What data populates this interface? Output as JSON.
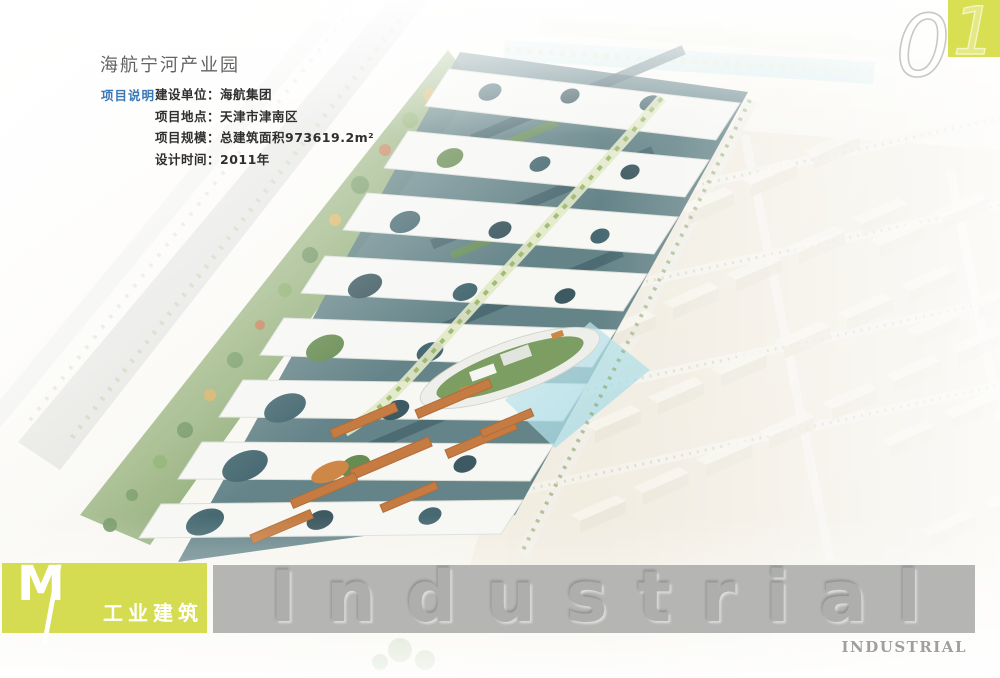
{
  "header": {
    "title": "海航宁河产业园",
    "section_label": "项目说明",
    "details": [
      {
        "label": "建设单位：",
        "value": "海航集团"
      },
      {
        "label": "项目地点：",
        "value": "天津市津南区"
      },
      {
        "label": "项目规模：",
        "value": "总建筑面积973619.2m²"
      },
      {
        "label": "设计时间：",
        "value": "2011年"
      }
    ]
  },
  "page_number": {
    "value": "01",
    "first_digit": "0",
    "second_digit": "1"
  },
  "footer": {
    "category_letter": "M",
    "category_divider": "/",
    "category_label": "工业建筑",
    "watermark": "Industrial",
    "corner_label": "INDUSTRIAL"
  },
  "image": {
    "alt": "海航宁河产业园鸟瞰效果图：白色开孔屋面带覆盖的玻璃厂房群、中央绿化景观轴、椭圆形绿顶办公楼与水景、橙色屋顶宿舍楼，左侧林荫道路，右侧为浅色仓储厂区"
  },
  "colors": {
    "accent_yellow_green": "#d5dc51",
    "watermark_band_gray": "#b0b0af",
    "section_label_blue": "#3a77b5",
    "title_gray": "#636363",
    "body_text": "#2f2f2f",
    "corner_label_gray": "#a09f9b"
  }
}
